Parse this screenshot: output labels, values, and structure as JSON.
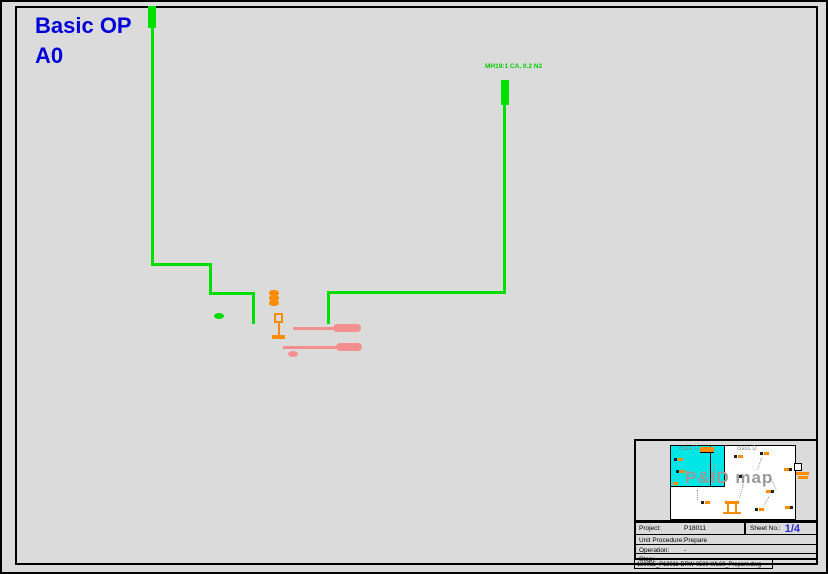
{
  "header": {
    "title_line1": "Basic OP",
    "title_line2": "A0"
  },
  "diagram": {
    "pipe_label": "MH19:1 CA, 0.2 N2"
  },
  "minimap": {
    "heading": "P&ID map",
    "left_region_label": "class C",
    "right_region_label": "class D"
  },
  "title_block": {
    "rows": [
      {
        "label": "Project:",
        "value": "P18011"
      },
      {
        "label": "Unit Procedure:",
        "value": "Prepare"
      },
      {
        "label": "Operation:",
        "value": "-"
      },
      {
        "label": "Step:",
        "value": "-"
      }
    ],
    "sheet_label": "Sheet  No.:",
    "sheet_value": "1/4",
    "filename": "180035_P18011-DRW-0500-WL60_Prepare.dwg"
  },
  "colors": {
    "background": "#dbdbdb",
    "pipe_green": "#00dd00",
    "accent_orange": "#ff8c00",
    "accent_pink": "#f29090",
    "highlight_cyan": "#00e5e5",
    "title_blue": "#0000d9",
    "sheet_blue": "#2a2ad0",
    "map_text_gray": "#9a9a9a"
  }
}
